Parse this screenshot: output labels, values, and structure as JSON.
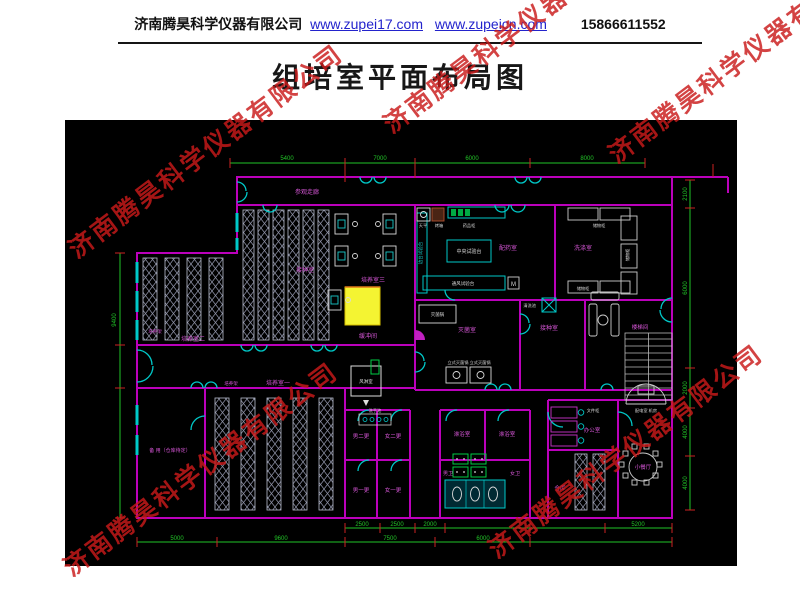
{
  "header": {
    "company": "济南腾昊科学仪器有限公司",
    "url1": "www.zupei17.com",
    "url2": "www.zupeicn.com",
    "phone": "15866611552"
  },
  "title": "组培室平面布局图",
  "watermark": "济南腾昊科学仪器有限公司",
  "colors": {
    "wall": "#bb00bb",
    "door": "#00c8c8",
    "dimension": "#00bb00",
    "tick": "#cc2222",
    "room_label": "#d455d4",
    "highlight": "#f4f432",
    "background": "#000000"
  },
  "plan": {
    "rooms": {
      "corridor": "参观走廊",
      "benchRoom": "接种室",
      "culture3": "培养室三",
      "buffer": "缓冲间",
      "culture2": "培养室二",
      "rackA": "培养架",
      "rackB": "培养架",
      "culture1": "培养室一",
      "prep": "配药室",
      "wash": "洗涤室",
      "sterilize": "灭菌室",
      "transfer": "接种室",
      "stairs": "楼梯间",
      "spare": "备 用（仓库待定）",
      "airshower": "风淋室",
      "handwash": "洗手池",
      "changeM2": "男二更",
      "changeF2": "女二更",
      "changeM1": "男一更",
      "changeF1": "女一更",
      "shower1": "淋浴室",
      "shower2": "淋浴室",
      "toiletM": "男卫",
      "toiletF": "女卫",
      "office": "办公室",
      "fileCab": "文件柜",
      "storage": "仓库",
      "dining": "小餐厅",
      "power": "配电室 机房",
      "sink": "清洗池"
    },
    "equipment": {
      "centralBench": "中央试验台",
      "sideBench": "边台试验台",
      "fumeBench": "通风试验台",
      "balance": "天平",
      "oven": "烤箱",
      "medCab": "药品柜",
      "sterilizerPot": "灭菌锅",
      "vertSterilizer": "立式灭菌锅 立式灭菌锅",
      "cabinet": "储物柜",
      "mbox": "M"
    },
    "dims": {
      "top": [
        "5400",
        "7000",
        "6000",
        "8000"
      ],
      "right": [
        "2100",
        "6000",
        "2000",
        "4000",
        "4000"
      ],
      "left": "9400",
      "bottomA": [
        "2500",
        "2500",
        "2000",
        "5200"
      ],
      "bottomB": [
        "5000",
        "9600",
        "7500",
        "6000"
      ]
    }
  }
}
